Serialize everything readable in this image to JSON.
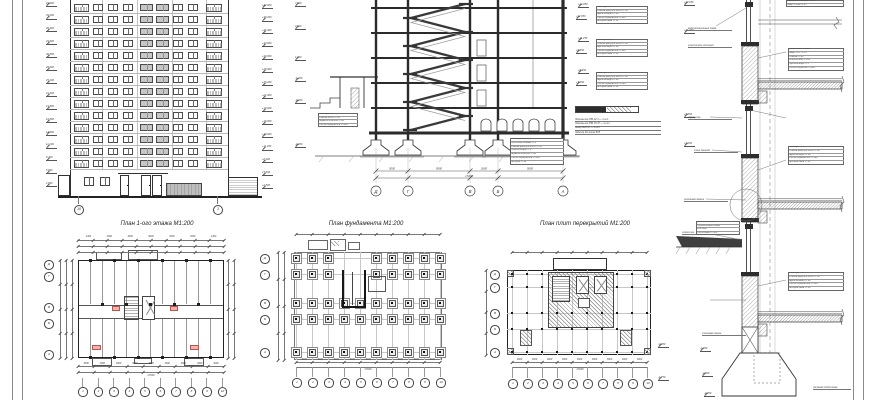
{
  "sheet": {
    "background": "#ffffff",
    "line_color": "#2b2b2b",
    "accent_pink": "#eeb3b0",
    "fill_gray": "#c6c6c6"
  },
  "titles": {
    "plan1": "План 1-ого этажа М1:200",
    "foundation": "План фундамента М1:200",
    "slabs": "План плит перекрытий М1:200"
  },
  "facade": {
    "axis_left": "10",
    "axis_right": "1",
    "left_marks": [
      "42.000",
      "39.200",
      "36.400",
      "33.600",
      "30.800",
      "28.000",
      "25.200",
      "22.400",
      "19.600",
      "16.800",
      "14.000",
      "11.200",
      "8.400",
      "5.600",
      "2.800"
    ],
    "right_marks": [
      "+42.000",
      "+39.200",
      "+36.400",
      "+33.600",
      "+30.800",
      "+28.000",
      "+25.200",
      "+22.400",
      "+19.600",
      "+16.800",
      "+14.000",
      "+11.200",
      "+8.400",
      "+5.600",
      "+2.800"
    ]
  },
  "section": {
    "axes": [
      "Д",
      "Г",
      "В",
      "Б",
      "А"
    ],
    "dims": [
      "3000",
      "5800",
      "2600",
      "5800"
    ],
    "total": "17200",
    "marks": [
      "7.800",
      "4.800",
      "1.800",
      "-1.200",
      "-4.200",
      "-4.050"
    ],
    "spec_left": [
      "Линолеум — 4",
      "Стяжка М150 — 30",
      "Керамзитобетон — 40",
      "Плита перекрытия — 220"
    ],
    "spec_right": [
      "Линолеум ПВХ — 4",
      "Прослойка клеевая — 1",
      "Стяжка цем.р-ра М150 — 30",
      "Гидроизоляция — 2",
      "Керамзитобетон — 40",
      "Плита перекрытия — 220",
      "Затирка — 10"
    ]
  },
  "annotations": {
    "marks": [
      "+14.050",
      "+12.650",
      "+11.250",
      "+9.850",
      "+8.450",
      "+7.050"
    ],
    "spec_rows": [
      "Линолеум — 4",
      "Стяжка цем.р-ра М150 — 30",
      "Звукоизоляция — 40",
      "Плита перекрытия — 220",
      "Затирка швов — 10"
    ],
    "lintel_rows": [
      "Перемычка 2ПБ 22-3 — 4 шт.",
      "Перемычка 3ПБ 18-37 — 2 шт.",
      "Анкер Ø10 АI — 4 шт.",
      "Заделка бетоном В15"
    ]
  },
  "plans": {
    "numbers": [
      "1",
      "2",
      "3",
      "4",
      "5",
      "6",
      "7",
      "8",
      "9",
      "10"
    ],
    "letters": [
      "Д",
      "Г",
      "В",
      "Б",
      "А"
    ],
    "seg_dim": "3000",
    "total_dim": "27000",
    "plan1_top_dims": [
      "1400",
      "3000",
      "3000",
      "6000",
      "3000",
      "3000",
      "1400"
    ]
  },
  "detail": {
    "mark_values": [
      "+44.050",
      "+41.050",
      "+8.050",
      "+5.250",
      "-1.050",
      "-2.550",
      "-4.050",
      "-0.050",
      "-1.750"
    ],
    "labels": [
      "водоизоляционный ковёр",
      "утеплитель плитный",
      "перемычка",
      "стык панелей",
      "цокольная панель",
      "отмостка",
      "стеновая панель",
      "песчаная подготовка"
    ],
    "top_rows": [
      "Гравий втопленный — 10",
      "Ковёр 4 слоя — 15"
    ],
    "roof_rows": [
      "Гравий втопленный",
      "Ковёр 4 сл. — 15",
      "Стяжка — 20",
      "Утеплитель — 120",
      "Пароизоляция — 1",
      "Плита покрытия — 220"
    ],
    "basement_rows": [
      "Цокольная панель",
      "Гидроизоляция обмаз.",
      "Блок ФБС",
      "Подготовка — 100"
    ]
  }
}
